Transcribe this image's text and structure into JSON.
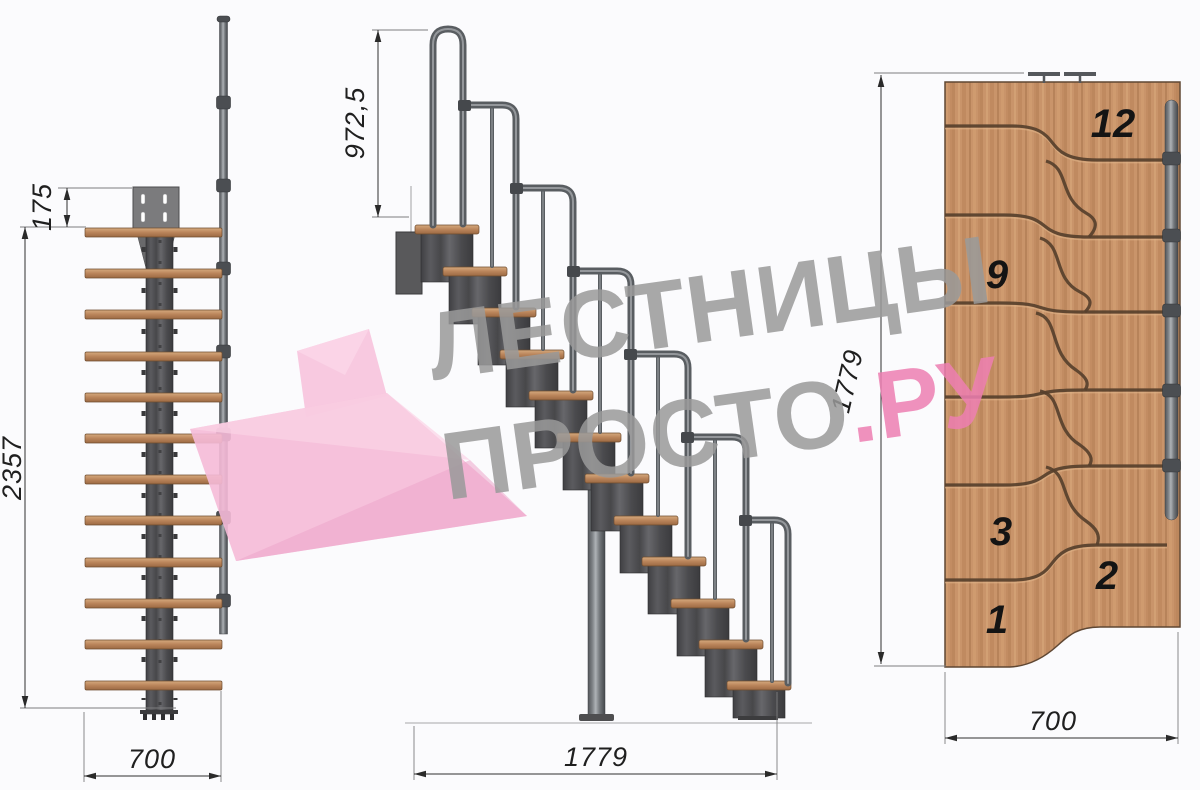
{
  "drawing": {
    "title_hint": "modular staircase technical drawing, three views",
    "front_view": {
      "dim_offset": "175",
      "dim_height": "2357",
      "dim_width": "700"
    },
    "side_view": {
      "dim_rail_height": "972,5",
      "dim_length": "1779"
    },
    "plan_view": {
      "dim_length": "1779",
      "dim_width": "700",
      "step_numbers": [
        "12",
        "9",
        "3",
        "2",
        "1"
      ]
    },
    "watermark": {
      "line1": "ЛЕСТНИЦЫ",
      "line2_gray": "ПРОСТО",
      "line2_pink": ".РУ"
    },
    "colors": {
      "wood": "#c9946a",
      "metal": "#4b4b4e",
      "tube": "#6e7276",
      "dimension": "#2f2f2f",
      "watermark_gray": "#9a9a9a",
      "watermark_pink": "#ee7fb2",
      "logo_pink": "#f5bad7"
    }
  }
}
